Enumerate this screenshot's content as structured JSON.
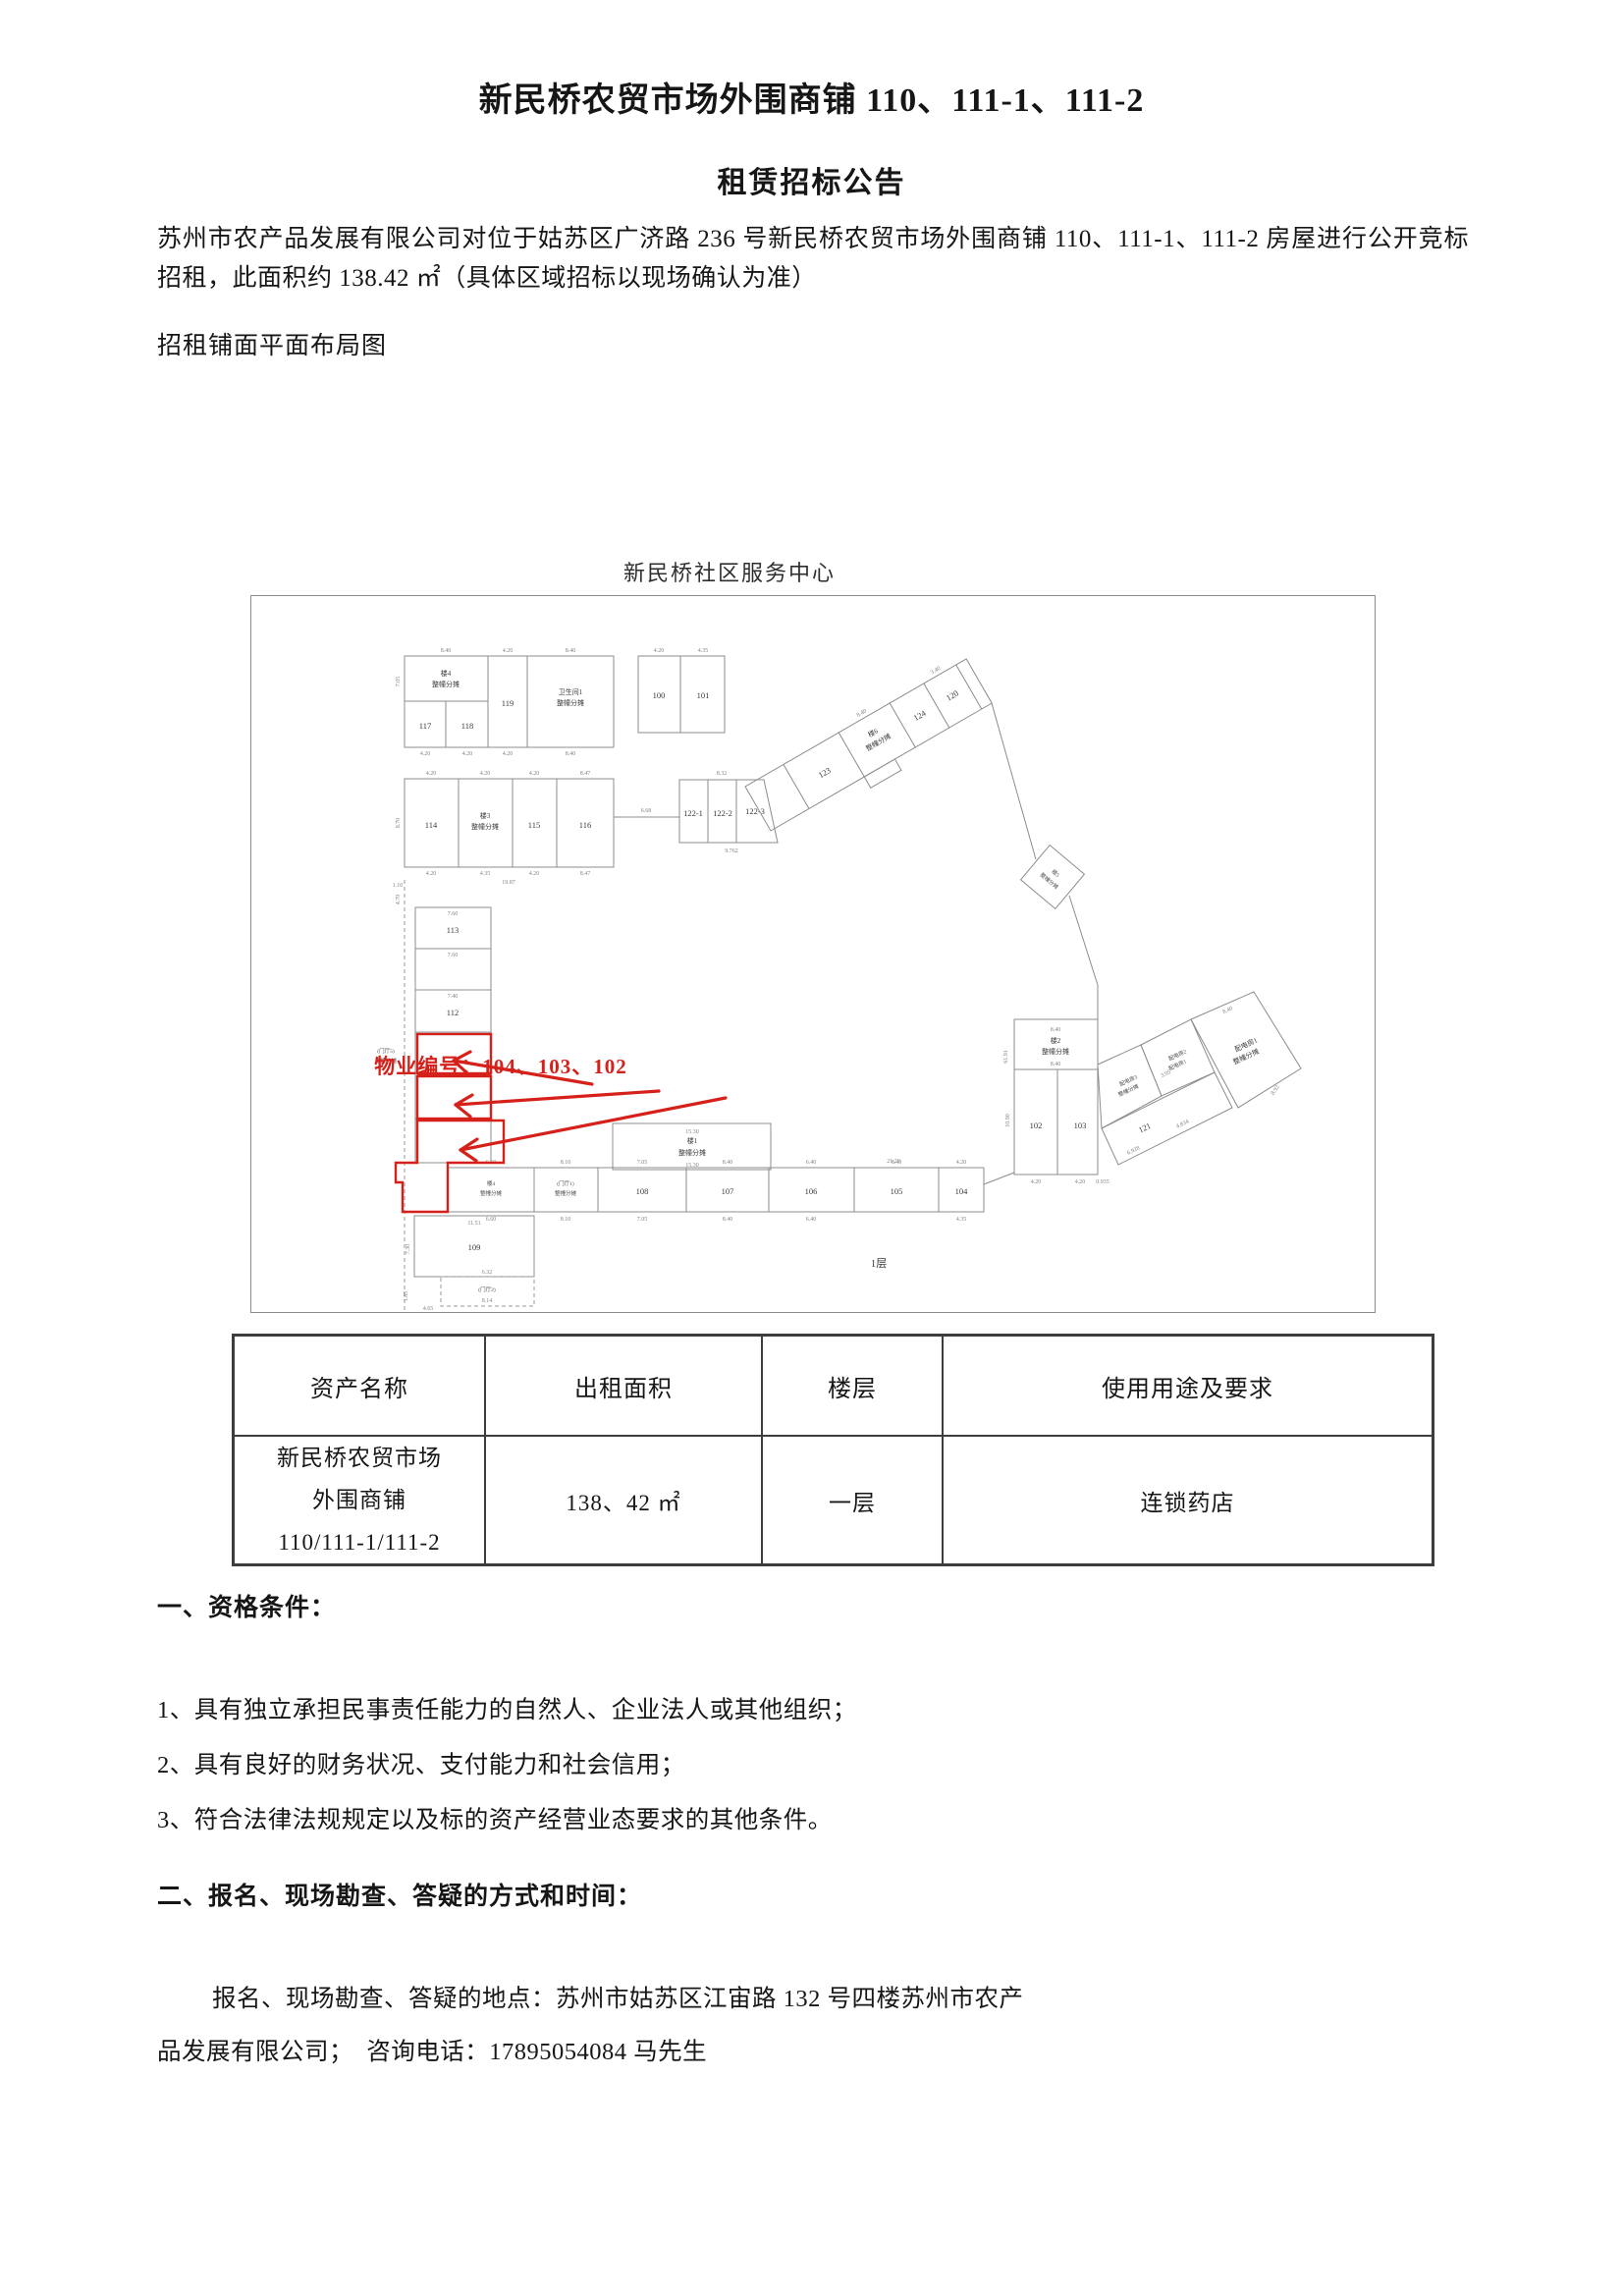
{
  "doc": {
    "title_line1": "新民桥农贸市场外围商铺 110、111-1、111-2",
    "title_line2": "租赁招标公告",
    "intro": "苏州市农产品发展有限公司对位于姑苏区广济路 236 号新民桥农贸市场外围商铺 110、111-1、111-2 房屋进行公开竞标招租，此面积约 138.42 ㎡（具体区域招标以现场确认为准）",
    "plan_caption": "招租铺面平面布局图"
  },
  "floor_plan": {
    "title": "新民桥社区服务中心",
    "annotation_label": "物业编号：104、103、102",
    "red_color": "#d6201a",
    "rooms": {
      "b1": "楼1",
      "b2": "楼2",
      "b3": "楼3",
      "b4": "楼4",
      "b5": "楼5",
      "b6": "楼6",
      "share": "整幢分摊",
      "wc1": "卫生间1",
      "hall1": "(门厅1)",
      "hall2": "(门厅2)",
      "hall5": "(门厅5)",
      "pd1": "配电房1",
      "pd2": "配电房2",
      "pd3": "配电房3",
      "r100": "100",
      "r101": "101",
      "r102": "102",
      "r103": "103",
      "r104": "104",
      "r105": "105",
      "r106": "106",
      "r107": "107",
      "r108": "108",
      "r109": "109",
      "r112": "112",
      "r113": "113",
      "r114": "114",
      "r115": "115",
      "r116": "116",
      "r117": "117",
      "r118": "118",
      "r119": "119",
      "r120": "120",
      "r121": "121",
      "r122_1": "122-1",
      "r122_2": "122-2",
      "r122_3": "122-3",
      "r123": "123",
      "r124": "124",
      "floor1": "1层"
    },
    "dims": [
      "8.40",
      "4.20",
      "8.40",
      "4.20",
      "4.20",
      "4.20",
      "8.40",
      "4.20",
      "4.35",
      "4.20",
      "4.20",
      "4.20",
      "8.47",
      "4.20",
      "4.35",
      "4.20",
      "8.47",
      "19.87",
      "6.68",
      "8.32",
      "9.762",
      "7.60",
      "7.60",
      "7.40",
      "15.30",
      "21.20",
      "11.51",
      "6.32",
      "8.40",
      "8.40",
      "10.90",
      "4.20",
      "4.20",
      "0.935",
      "8.92",
      "3.95",
      "4.834",
      "6.928",
      "8.40",
      "6.60",
      "8.10",
      "7.05",
      "8.40",
      "6.40",
      "8.40",
      "4.20",
      "6.60",
      "8.10",
      "7.05",
      "8.40",
      "6.40",
      "4.35",
      "8.70",
      "7.05",
      "3.40",
      "8.40",
      "4.70",
      "1.85",
      "4.65",
      "1.10",
      "8.14",
      "7.30",
      "61.91"
    ]
  },
  "table": {
    "headers": [
      "资产名称",
      "出租面积",
      "楼层",
      "使用用途及要求"
    ],
    "row": {
      "asset_line1": "新民桥农贸市场",
      "asset_line2": "外围商铺",
      "asset_line3": "110/111-1/111-2",
      "area": "138、42 ㎡",
      "floor": "一层",
      "usage": "连锁药店"
    }
  },
  "section1": {
    "heading": "一、资格条件：",
    "items": [
      "1、具有独立承担民事责任能力的自然人、企业法人或其他组织；",
      "2、具有良好的财务状况、支付能力和社会信用；",
      "3、符合法律法规规定以及标的资产经营业态要求的其他条件。"
    ]
  },
  "section2": {
    "heading": "二、报名、现场勘查、答疑的方式和时间：",
    "line1": "报名、现场勘查、答疑的地点：苏州市姑苏区江宙路 132 号四楼苏州市农产",
    "line2": "品发展有限公司；  咨询电话：17895054084 马先生"
  }
}
